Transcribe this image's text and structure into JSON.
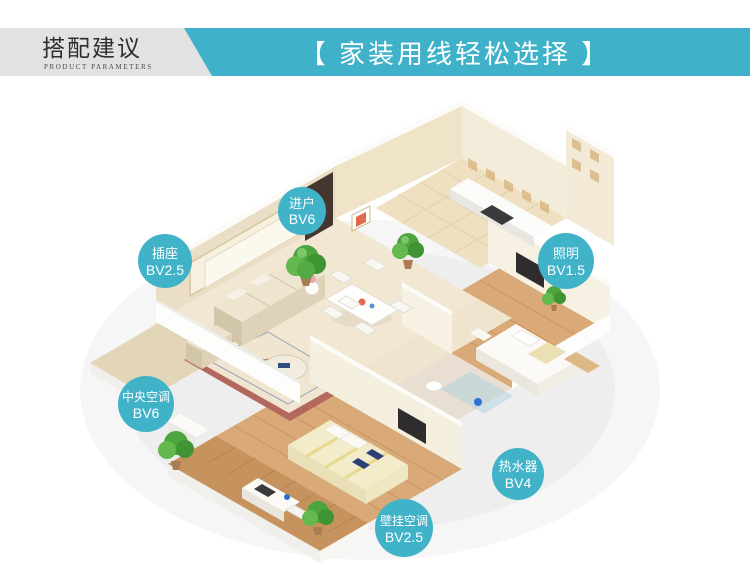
{
  "header": {
    "band_color": "#e2e2e2",
    "accent_color": "#3fb2c9",
    "title_cn": "搭配建议",
    "title_en": "PRODUCT PARAMETERS",
    "banner_text": "【 家装用线轻松选择 】"
  },
  "floorplan": {
    "bubble_color": "#41b3c9",
    "bubbles": [
      {
        "id": "entry",
        "label": "进户",
        "spec": "BV6"
      },
      {
        "id": "socket",
        "label": "插座",
        "spec": "BV2.5"
      },
      {
        "id": "lighting",
        "label": "照明",
        "spec": "BV1.5"
      },
      {
        "id": "central-ac",
        "label": "中央空调",
        "spec": "BV6"
      },
      {
        "id": "water-heater",
        "label": "热水器",
        "spec": "BV4"
      },
      {
        "id": "wall-ac",
        "label": "壁挂空调",
        "spec": "BV2.5"
      }
    ]
  }
}
